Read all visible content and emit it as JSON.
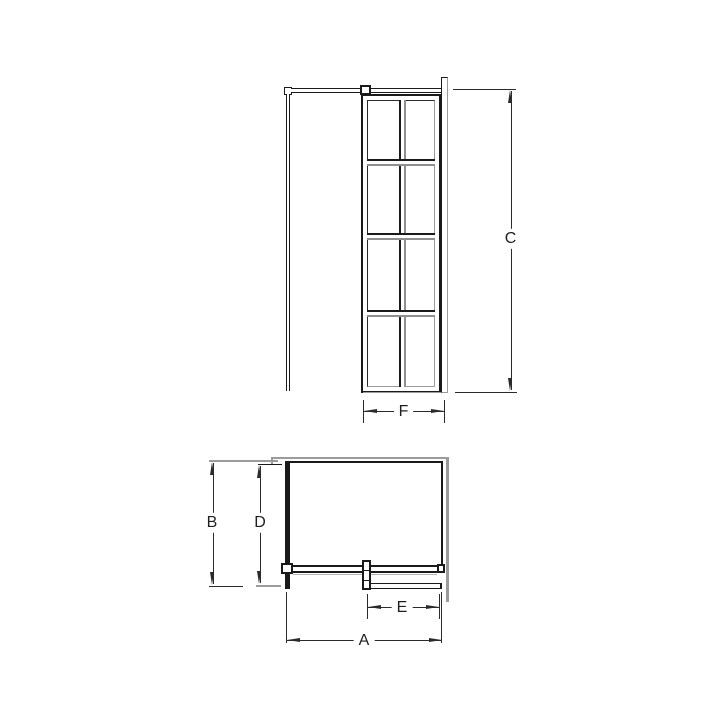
{
  "drawing": {
    "type": "technical-dimension-drawing",
    "subject": "walk-in shower screen with grid panel, support bar and side panel",
    "labels": {
      "A": "A",
      "B": "B",
      "C": "C",
      "D": "D",
      "E": "E",
      "F": "F"
    },
    "views": {
      "front_elevation": {
        "title": "front elevation",
        "dimensions": [
          "C",
          "F"
        ]
      },
      "plan": {
        "title": "plan view",
        "dimensions": [
          "A",
          "B",
          "D",
          "E"
        ]
      }
    },
    "grid_panel": {
      "columns": 2,
      "rows": 4
    },
    "colors": {
      "background": "#ffffff",
      "line": "#1a1a1a",
      "shadow": "#9b9b9b",
      "dimension": "#2b2b2b",
      "label_text": "#1f1f1f"
    }
  }
}
